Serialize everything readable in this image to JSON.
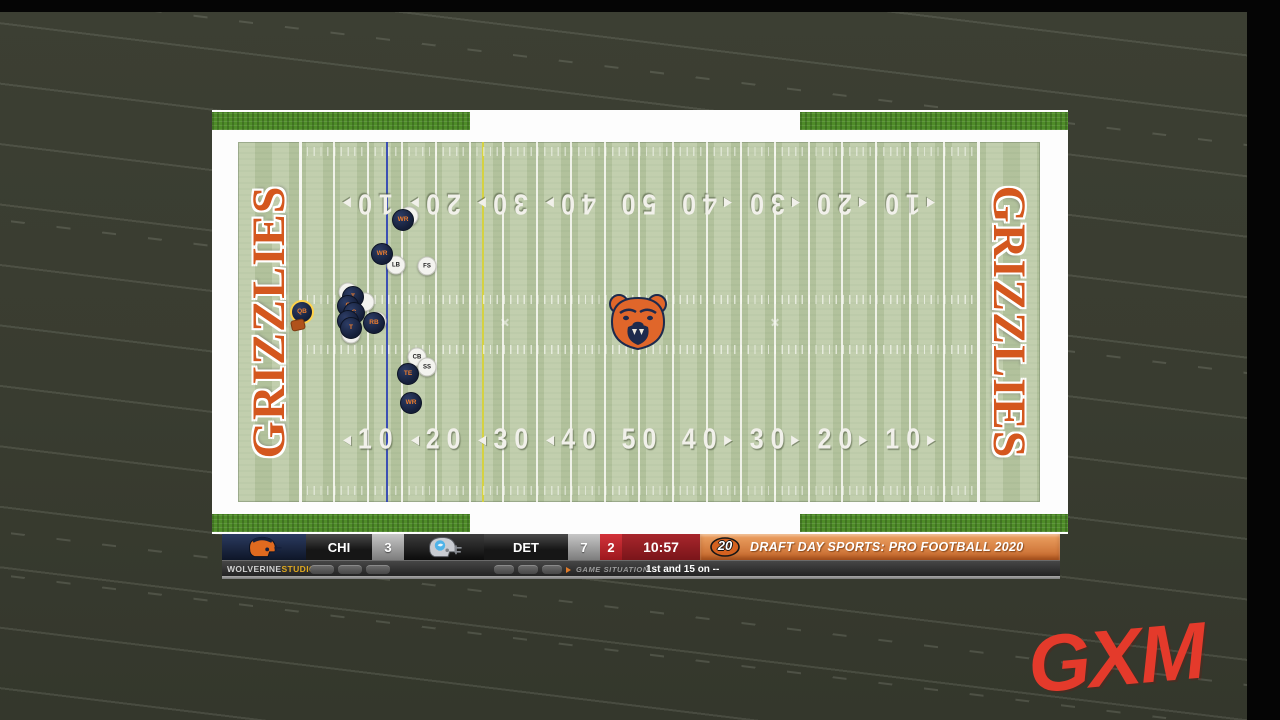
{
  "background": {
    "faded_yard_numbers": [
      "30",
      "30"
    ]
  },
  "field": {
    "endzone_text": "GRIZZLIES",
    "yard_numbers": [
      "10",
      "20",
      "30",
      "40",
      "50",
      "40",
      "30",
      "20",
      "10"
    ],
    "colors": {
      "turf": "#b9c8a3",
      "endzone_letters": "#d4571e",
      "line_of_scrimmage": "#2e41b4",
      "first_down_line": "#d6d23c"
    },
    "icons": {
      "midfield_logo": "bear-head-logo"
    }
  },
  "players": {
    "offense": [
      {
        "pos": "WR",
        "x": 165,
        "y": 78
      },
      {
        "pos": "WR",
        "x": 144,
        "y": 112
      },
      {
        "pos": "QB",
        "x": 64,
        "y": 170,
        "ring": true
      },
      {
        "pos": "T",
        "x": 115,
        "y": 155
      },
      {
        "pos": "G",
        "x": 110,
        "y": 164
      },
      {
        "pos": "C",
        "x": 116,
        "y": 171
      },
      {
        "pos": "G",
        "x": 110,
        "y": 179
      },
      {
        "pos": "T",
        "x": 113,
        "y": 186
      },
      {
        "pos": "RB",
        "x": 136,
        "y": 181
      },
      {
        "pos": "TE",
        "x": 170,
        "y": 232
      },
      {
        "pos": "WR",
        "x": 173,
        "y": 261
      }
    ],
    "defense": [
      {
        "pos": "",
        "x": 171,
        "y": 74
      },
      {
        "pos": "LB",
        "x": 158,
        "y": 123
      },
      {
        "pos": "FS",
        "x": 189,
        "y": 124
      },
      {
        "pos": "",
        "x": 110,
        "y": 150
      },
      {
        "pos": "",
        "x": 127,
        "y": 160
      },
      {
        "pos": "",
        "x": 139,
        "y": 179
      },
      {
        "pos": "",
        "x": 113,
        "y": 192
      },
      {
        "pos": "CB",
        "x": 179,
        "y": 215
      },
      {
        "pos": "SS",
        "x": 189,
        "y": 225
      }
    ],
    "ball": {
      "x": 60,
      "y": 183
    }
  },
  "scoreboard": {
    "away": {
      "abbr": "CHI",
      "score": "3",
      "helmet_icon": "orange-navy-helmet"
    },
    "home": {
      "abbr": "DET",
      "score": "7",
      "helmet_icon": "silver-blue-helmet"
    },
    "quarter": "2",
    "clock": "10:57",
    "banner": {
      "logo": "20",
      "title": "DRAFT DAY SPORTS: PRO FOOTBALL 2020"
    }
  },
  "status_bar": {
    "brand_bold": "WOLVERINE",
    "brand_accent": "STUDIOS",
    "situation_label": "GAME SITUATION",
    "down_distance": "1st and 15 on --"
  },
  "watermark": {
    "text": "GXM"
  }
}
